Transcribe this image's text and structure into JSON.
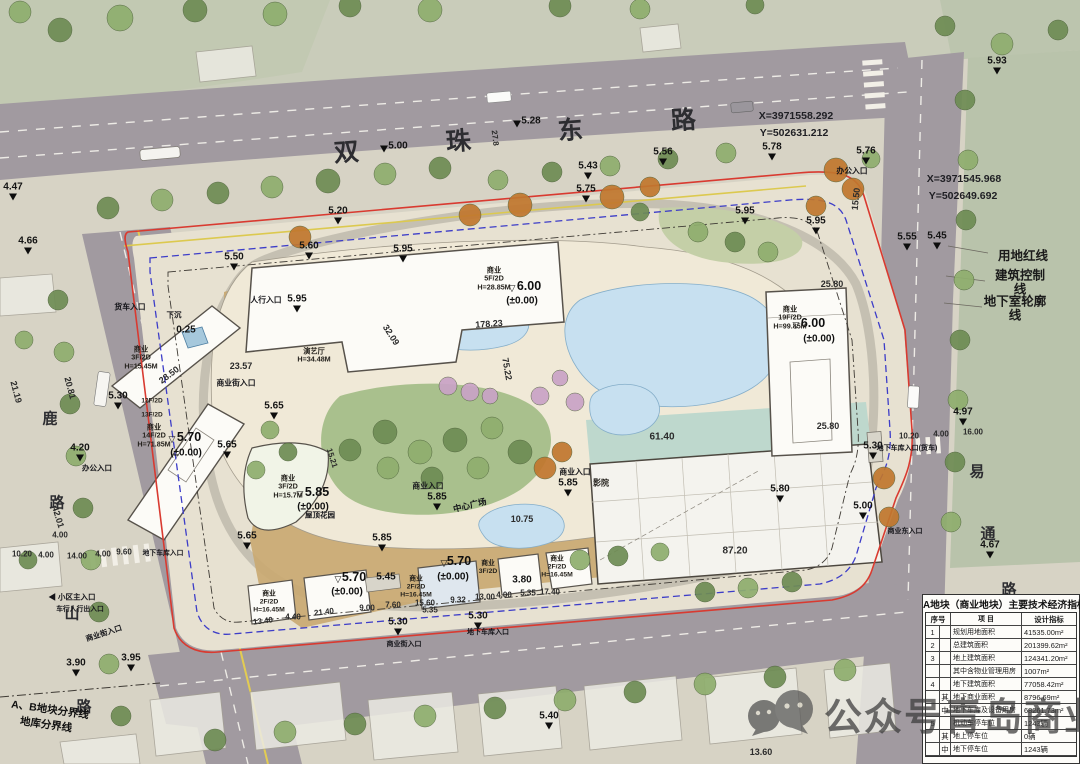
{
  "watermark": {
    "text": "公众号青岛商业"
  },
  "legend": {
    "items": [
      "用地红线",
      "建筑控制线",
      "地下室轮廓线"
    ]
  },
  "coords": {
    "top": [
      "X=3971558.292",
      "Y=502631.212"
    ],
    "right": [
      "X=3971545.968",
      "Y=502649.692"
    ]
  },
  "roads": {
    "top_road": "双珠东路",
    "left_road": "鹿山路",
    "right_road": "易通路"
  },
  "table": {
    "title": "A地块（商业地块）主要技术经济指标",
    "headers": [
      "序号",
      "项 目",
      "设计指标"
    ],
    "rows": [
      {
        "seq": "1",
        "sub": "",
        "item": "规划用地面积",
        "val": "41535.00m²"
      },
      {
        "seq": "2",
        "sub": "",
        "item": "总建筑面积",
        "val": "201399.62m²"
      },
      {
        "seq": "3",
        "sub": "",
        "item": "地上建筑面积",
        "val": "124341.20m²"
      },
      {
        "seq": "",
        "sub": "",
        "item": "其中含物业管理用房",
        "val": "1007m²"
      },
      {
        "seq": "4",
        "sub": "",
        "item": "地下建筑面积",
        "val": "77058.42m²"
      },
      {
        "seq": "",
        "sub": "其",
        "item": "地下商业面积",
        "val": "8796.69m²"
      },
      {
        "seq": "",
        "sub": "中",
        "item": "地下车库及设备用房",
        "val": "68261.73m²"
      },
      {
        "seq": "5",
        "sub": "",
        "item": "机动车停车位",
        "val": "1243辆"
      },
      {
        "seq": "",
        "sub": "其",
        "item": "地上停车位",
        "val": "0辆"
      },
      {
        "seq": "",
        "sub": "中",
        "item": "地下停车位",
        "val": "1243辆"
      }
    ]
  },
  "labels": [
    {
      "t": "双",
      "x": 347,
      "y": 153,
      "c": "rd",
      "r": -4
    },
    {
      "t": "珠",
      "x": 459,
      "y": 142,
      "c": "rd",
      "r": -4
    },
    {
      "t": "东",
      "x": 571,
      "y": 131,
      "c": "rd",
      "r": -4
    },
    {
      "t": "路",
      "x": 684,
      "y": 121,
      "c": "rd",
      "r": -4
    },
    {
      "t": "鹿",
      "x": 50,
      "y": 419,
      "c": "ch"
    },
    {
      "t": "路",
      "x": 57,
      "y": 503,
      "c": "ch"
    },
    {
      "t": "山",
      "x": 72,
      "y": 614,
      "c": "ch"
    },
    {
      "t": "路",
      "x": 84,
      "y": 707,
      "c": "ch"
    },
    {
      "t": "易",
      "x": 977,
      "y": 472,
      "c": "ch"
    },
    {
      "t": "通",
      "x": 988,
      "y": 534,
      "c": "ch"
    },
    {
      "t": "路",
      "x": 1009,
      "y": 590,
      "c": "ch"
    },
    {
      "t": "5.00",
      "x": 398,
      "y": 146,
      "c": "el",
      "tri": 1,
      "tx": -14,
      "ty": 3
    },
    {
      "t": "5.28",
      "x": 531,
      "y": 121,
      "c": "el",
      "tri": 1,
      "tx": -14,
      "ty": 3
    },
    {
      "t": "5.43",
      "x": 588,
      "y": 166,
      "c": "el",
      "tri": 1
    },
    {
      "t": "5.56",
      "x": 663,
      "y": 152,
      "c": "el",
      "tri": 1
    },
    {
      "t": "5.75",
      "x": 586,
      "y": 189,
      "c": "el",
      "tri": 1
    },
    {
      "t": "5.95",
      "x": 745,
      "y": 211,
      "c": "el",
      "tri": 1
    },
    {
      "t": "5.78",
      "x": 772,
      "y": 147,
      "c": "el",
      "tri": 1
    },
    {
      "t": "5.76",
      "x": 866,
      "y": 151,
      "c": "el",
      "tri": 1
    },
    {
      "t": "5.93",
      "x": 997,
      "y": 61,
      "c": "el",
      "tri": 1
    },
    {
      "t": "5.20",
      "x": 338,
      "y": 211,
      "c": "el",
      "tri": 1
    },
    {
      "t": "5.60",
      "x": 309,
      "y": 246,
      "c": "el",
      "tri": 1
    },
    {
      "t": "5.50",
      "x": 234,
      "y": 257,
      "c": "el",
      "tri": 1
    },
    {
      "t": "5.95",
      "x": 403,
      "y": 249,
      "c": "el",
      "tri": 1
    },
    {
      "t": "5.95",
      "x": 816,
      "y": 221,
      "c": "el",
      "tri": 1
    },
    {
      "t": "5.55",
      "x": 907,
      "y": 237,
      "c": "el",
      "tri": 1
    },
    {
      "t": "5.45",
      "x": 937,
      "y": 236,
      "c": "el",
      "tri": 1
    },
    {
      "t": "4.97",
      "x": 963,
      "y": 412,
      "c": "el",
      "tri": 1
    },
    {
      "t": "5.30",
      "x": 873,
      "y": 446,
      "c": "el",
      "tri": 1
    },
    {
      "t": "5.00",
      "x": 863,
      "y": 506,
      "c": "el",
      "tri": 1
    },
    {
      "t": "4.67",
      "x": 990,
      "y": 545,
      "c": "el",
      "tri": 1
    },
    {
      "t": "4.47",
      "x": 13,
      "y": 187,
      "c": "el",
      "tri": 1
    },
    {
      "t": "4.66",
      "x": 28,
      "y": 241,
      "c": "el",
      "tri": 1
    },
    {
      "t": "5.30",
      "x": 118,
      "y": 396,
      "c": "el",
      "tri": 1
    },
    {
      "t": "4.20",
      "x": 80,
      "y": 448,
      "c": "el",
      "tri": 1
    },
    {
      "t": "3.90",
      "x": 76,
      "y": 663,
      "c": "el",
      "tri": 1
    },
    {
      "t": "3.95",
      "x": 131,
      "y": 658,
      "c": "el",
      "tri": 1
    },
    {
      "t": "5.30",
      "x": 398,
      "y": 622,
      "c": "el",
      "tri": 1
    },
    {
      "t": "5.30",
      "x": 478,
      "y": 616,
      "c": "el",
      "tri": 1
    },
    {
      "t": "5.40",
      "x": 549,
      "y": 716,
      "c": "el",
      "tri": 1
    },
    {
      "t": "5.65",
      "x": 274,
      "y": 406,
      "c": "el",
      "tri": 1
    },
    {
      "t": "5.65",
      "x": 227,
      "y": 445,
      "c": "el",
      "tri": 1
    },
    {
      "t": "5.65",
      "x": 247,
      "y": 536,
      "c": "el",
      "tri": 1
    },
    {
      "t": "5.85",
      "x": 437,
      "y": 497,
      "c": "el",
      "tri": 1
    },
    {
      "t": "5.85",
      "x": 568,
      "y": 483,
      "c": "el",
      "tri": 1
    },
    {
      "t": "5.85",
      "x": 382,
      "y": 538,
      "c": "el",
      "tri": 1
    },
    {
      "t": "5.80",
      "x": 780,
      "y": 489,
      "c": "el",
      "tri": 1
    },
    {
      "t": "5.95",
      "x": 297,
      "y": 299,
      "c": "el",
      "tri": 1
    },
    {
      "t": "5.45",
      "x": 386,
      "y": 577,
      "c": "el"
    },
    {
      "t": "6.00",
      "x": 529,
      "y": 286,
      "c": "el2"
    },
    {
      "t": "▽",
      "x": 512,
      "y": 288,
      "c": "otri"
    },
    {
      "t": "(±0.00)",
      "x": 522,
      "y": 301,
      "c": "pm"
    },
    {
      "t": "6.00",
      "x": 813,
      "y": 323,
      "c": "el2"
    },
    {
      "t": "▽",
      "x": 796,
      "y": 325,
      "c": "otri"
    },
    {
      "t": "(±0.00)",
      "x": 819,
      "y": 339,
      "c": "pm"
    },
    {
      "t": "5.70",
      "x": 189,
      "y": 437,
      "c": "el2"
    },
    {
      "t": "▽",
      "x": 172,
      "y": 439,
      "c": "otri"
    },
    {
      "t": "(±0.00)",
      "x": 186,
      "y": 453,
      "c": "pm"
    },
    {
      "t": "5.85",
      "x": 317,
      "y": 492,
      "c": "el2"
    },
    {
      "t": "▽",
      "x": 300,
      "y": 494,
      "c": "otri"
    },
    {
      "t": "(±0.00)",
      "x": 313,
      "y": 507,
      "c": "pm"
    },
    {
      "t": "5.70",
      "x": 354,
      "y": 577,
      "c": "el2"
    },
    {
      "t": "▽",
      "x": 338,
      "y": 579,
      "c": "otri"
    },
    {
      "t": "(±0.00)",
      "x": 347,
      "y": 592,
      "c": "pm"
    },
    {
      "t": "5.70",
      "x": 459,
      "y": 561,
      "c": "el2"
    },
    {
      "t": "▽",
      "x": 444,
      "y": 563,
      "c": "otri"
    },
    {
      "t": "(±0.00)",
      "x": 453,
      "y": 577,
      "c": "pm"
    },
    {
      "t": "3.80",
      "x": 522,
      "y": 580,
      "c": "el"
    },
    {
      "t": "0.25",
      "x": 186,
      "y": 330,
      "c": "el"
    },
    {
      "t": "10.75",
      "x": 522,
      "y": 519,
      "c": "dim"
    },
    {
      "t": "27.8",
      "x": 495,
      "y": 138,
      "c": "dim",
      "r": 83,
      "s": 8
    },
    {
      "t": "21.19",
      "x": 16,
      "y": 392,
      "c": "dim",
      "r": 75
    },
    {
      "t": "20.81",
      "x": 70,
      "y": 388,
      "c": "dim",
      "r": 75
    },
    {
      "t": "42.01",
      "x": 58,
      "y": 517,
      "c": "dim",
      "r": 73
    },
    {
      "t": "4.00",
      "x": 60,
      "y": 535,
      "c": "dim",
      "s": 8
    },
    {
      "t": "10.20",
      "x": 22,
      "y": 554,
      "c": "dim",
      "s": 8
    },
    {
      "t": "4.00",
      "x": 46,
      "y": 555,
      "c": "dim",
      "s": 8
    },
    {
      "t": "14.00",
      "x": 77,
      "y": 556,
      "c": "dim",
      "s": 8
    },
    {
      "t": "4.00",
      "x": 103,
      "y": 554,
      "c": "dim",
      "s": 8
    },
    {
      "t": "9.60",
      "x": 124,
      "y": 552,
      "c": "dim",
      "s": 8
    },
    {
      "t": "10.20",
      "x": 909,
      "y": 436,
      "c": "dim",
      "s": 8
    },
    {
      "t": "4.00",
      "x": 941,
      "y": 434,
      "c": "dim",
      "s": 8
    },
    {
      "t": "16.00",
      "x": 973,
      "y": 432,
      "c": "dim",
      "s": 8
    },
    {
      "t": "15.50",
      "x": 856,
      "y": 199,
      "c": "dim",
      "r": -84
    },
    {
      "t": "25.80",
      "x": 832,
      "y": 284,
      "c": "dim"
    },
    {
      "t": "25.80",
      "x": 828,
      "y": 426,
      "c": "dim"
    },
    {
      "t": "23.57",
      "x": 241,
      "y": 366,
      "c": "dim"
    },
    {
      "t": "28.50",
      "x": 169,
      "y": 375,
      "c": "dim",
      "r": -37
    },
    {
      "t": "32.09",
      "x": 391,
      "y": 335,
      "c": "dim",
      "r": 57
    },
    {
      "t": "178.23",
      "x": 489,
      "y": 324,
      "c": "dim",
      "r": -4
    },
    {
      "t": "75.22",
      "x": 507,
      "y": 369,
      "c": "dim",
      "r": 80
    },
    {
      "t": "15.21",
      "x": 332,
      "y": 458,
      "c": "dim",
      "r": 72,
      "s": 8
    },
    {
      "t": "61.40",
      "x": 662,
      "y": 437,
      "c": "dim",
      "s": 10
    },
    {
      "t": "87.20",
      "x": 735,
      "y": 551,
      "c": "dim",
      "s": 10
    },
    {
      "t": "13.40",
      "x": 263,
      "y": 621,
      "c": "dim",
      "r": -7,
      "s": 8
    },
    {
      "t": "4.40",
      "x": 293,
      "y": 617,
      "c": "dim",
      "s": 8
    },
    {
      "t": "21.40",
      "x": 324,
      "y": 612,
      "c": "dim",
      "r": -7,
      "s": 8
    },
    {
      "t": "9.00",
      "x": 367,
      "y": 608,
      "c": "dim",
      "s": 8
    },
    {
      "t": "7.60",
      "x": 393,
      "y": 605,
      "c": "dim",
      "s": 8
    },
    {
      "t": "15.60",
      "x": 425,
      "y": 603,
      "c": "dim",
      "s": 8
    },
    {
      "t": "5.35",
      "x": 430,
      "y": 610,
      "c": "dim",
      "s": 8
    },
    {
      "t": "9.32",
      "x": 458,
      "y": 600,
      "c": "dim",
      "s": 8
    },
    {
      "t": "13.00",
      "x": 485,
      "y": 597,
      "c": "dim",
      "s": 8
    },
    {
      "t": "4.00",
      "x": 504,
      "y": 595,
      "c": "dim",
      "s": 8
    },
    {
      "t": "5.35",
      "x": 528,
      "y": 593,
      "c": "dim",
      "s": 8
    },
    {
      "t": "17.40",
      "x": 550,
      "y": 592,
      "c": "dim",
      "s": 8
    },
    {
      "t": "13.60",
      "x": 761,
      "y": 752,
      "c": "dim"
    },
    {
      "t": "商业\n5F/2D\nH=28.85M",
      "x": 494,
      "y": 279,
      "c": "bld"
    },
    {
      "t": "演艺厅\nH=34.48M",
      "x": 314,
      "y": 356,
      "c": "bld"
    },
    {
      "t": "商业\n3F/2D\nH=15.45M",
      "x": 141,
      "y": 358,
      "c": "bld"
    },
    {
      "t": "12F/2D",
      "x": 152,
      "y": 401,
      "c": "bld",
      "s": 6.5
    },
    {
      "t": "13F/2D",
      "x": 152,
      "y": 415,
      "c": "bld",
      "s": 6.5
    },
    {
      "t": "商业\n14F/2D\nH=71.85M",
      "x": 154,
      "y": 436,
      "c": "bld"
    },
    {
      "t": "商业\n19F/2D\nH=99.85M",
      "x": 790,
      "y": 318,
      "c": "bld"
    },
    {
      "t": "商业\n3F/2D\nH=15.7M",
      "x": 288,
      "y": 487,
      "c": "bld"
    },
    {
      "t": "影院",
      "x": 601,
      "y": 483,
      "c": "bld",
      "s": 8
    },
    {
      "t": "商业\n2F/2D\nH=16.45M",
      "x": 269,
      "y": 602,
      "c": "bld",
      "s": 6.8
    },
    {
      "t": "商业\n2F/2D\nH=16.45M",
      "x": 416,
      "y": 587,
      "c": "bld",
      "s": 6.8
    },
    {
      "t": "商业\n3F/2D",
      "x": 488,
      "y": 568,
      "c": "bld",
      "s": 6.8
    },
    {
      "t": "商业\n2F/2D\nH=16.45M",
      "x": 557,
      "y": 567,
      "c": "bld",
      "s": 6.8
    },
    {
      "t": "屋顶花园",
      "x": 320,
      "y": 516,
      "c": "ent",
      "s": 7.5
    },
    {
      "t": "中心广场",
      "x": 470,
      "y": 506,
      "c": "ent",
      "s": 8.5,
      "r": -14
    },
    {
      "t": "下沉",
      "x": 174,
      "y": 316,
      "c": "ent",
      "s": 7.5
    },
    {
      "t": "人行入口",
      "x": 266,
      "y": 301,
      "c": "ent"
    },
    {
      "t": "货车入口",
      "x": 130,
      "y": 308,
      "c": "ent"
    },
    {
      "t": "商业街入口",
      "x": 236,
      "y": 384,
      "c": "ent"
    },
    {
      "t": "商业入口",
      "x": 428,
      "y": 487,
      "c": "ent"
    },
    {
      "t": "商业入口",
      "x": 575,
      "y": 473,
      "c": "ent"
    },
    {
      "t": "办公入口",
      "x": 852,
      "y": 172,
      "c": "ent"
    },
    {
      "t": "地下车库入口(货车)",
      "x": 907,
      "y": 449,
      "c": "ent",
      "s": 7
    },
    {
      "t": "商业东入口",
      "x": 905,
      "y": 532,
      "c": "ent",
      "s": 7
    },
    {
      "t": "办公入口",
      "x": 97,
      "y": 469,
      "c": "ent",
      "s": 7.5
    },
    {
      "t": "◀ 小区主入口",
      "x": 72,
      "y": 598,
      "c": "ent",
      "s": 7.5
    },
    {
      "t": "车行人行出入口",
      "x": 80,
      "y": 610,
      "c": "ent",
      "s": 6.8
    },
    {
      "t": "地下车库入口",
      "x": 163,
      "y": 554,
      "c": "ent",
      "s": 6.8
    },
    {
      "t": "商业街入口",
      "x": 104,
      "y": 634,
      "c": "ent",
      "s": 7.5,
      "r": -18
    },
    {
      "t": "商业街入口",
      "x": 404,
      "y": 645,
      "c": "ent",
      "s": 7
    },
    {
      "t": "地下车库入口",
      "x": 488,
      "y": 633,
      "c": "ent",
      "s": 7
    },
    {
      "t": "A、B地块分界线",
      "x": 50,
      "y": 710,
      "c": "bl",
      "r": 8
    },
    {
      "t": "地库分界线",
      "x": 46,
      "y": 725,
      "c": "bl",
      "r": 8
    }
  ]
}
